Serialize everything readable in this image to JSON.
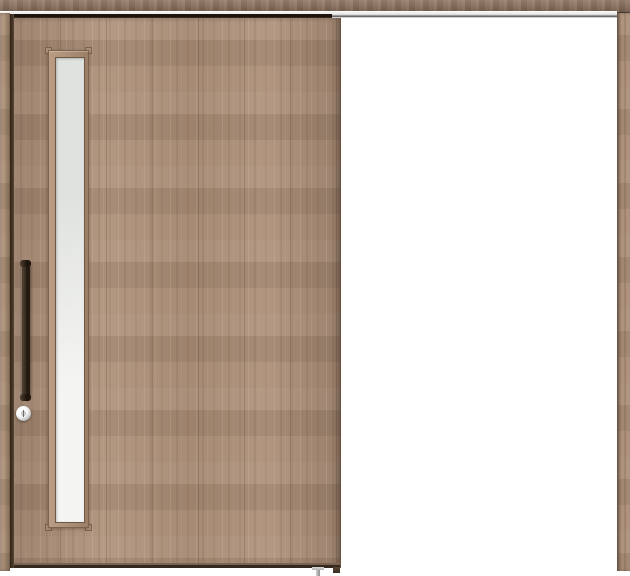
{
  "meta": {
    "type": "product-photo",
    "subject": "single-panel wood sliding door shown in open position with empty doorway on the right",
    "visible_text": ""
  },
  "components": {
    "lintel": "wood header board across full width",
    "track": "metal sliding rail under the lintel",
    "left_casing": "vertical wood frame stile, left edge",
    "right_casing": "vertical wood frame stile, right edge",
    "door_panel": "light walnut wood door slab with vertical grain",
    "glass_slit": "tall narrow frosted glass window near the left side of the door",
    "glass_slit_frame": "wood trim frame with small square corner blocks",
    "handle": "vertical dark-bronze bar pull handle",
    "lock": "round chrome thumb-turn lock below the handle",
    "floor_guide": "small grey floor guide at the bottom of the doorway",
    "door_bottom_guide": "dark guide block at the door's bottom right corner"
  },
  "colors": {
    "background": "#ffffff",
    "wood_base": "#ac8e76",
    "wood_dark": "#8a6f5a",
    "wood_light": "#c6ac94",
    "casing": "#a5876f",
    "groove": "#463526",
    "door_edge": "#6b5443",
    "track_silver": "#d9d9d9",
    "track_highlight": "#fcfcfc",
    "track_shadow": "#1d150d",
    "glass_light": "#f4f5f3",
    "glass_dark": "#e0e2e0",
    "glass_frame": "#af9179",
    "glass_frame_line": "#7c6350",
    "handle_dark": "#231a12",
    "handle_mid": "#3c2f23",
    "handle_highlight": "#847465",
    "lock_ring": "#bdbdbd",
    "lock_face": "#f3f3f3",
    "guide_grey": "#b0b0b0"
  }
}
